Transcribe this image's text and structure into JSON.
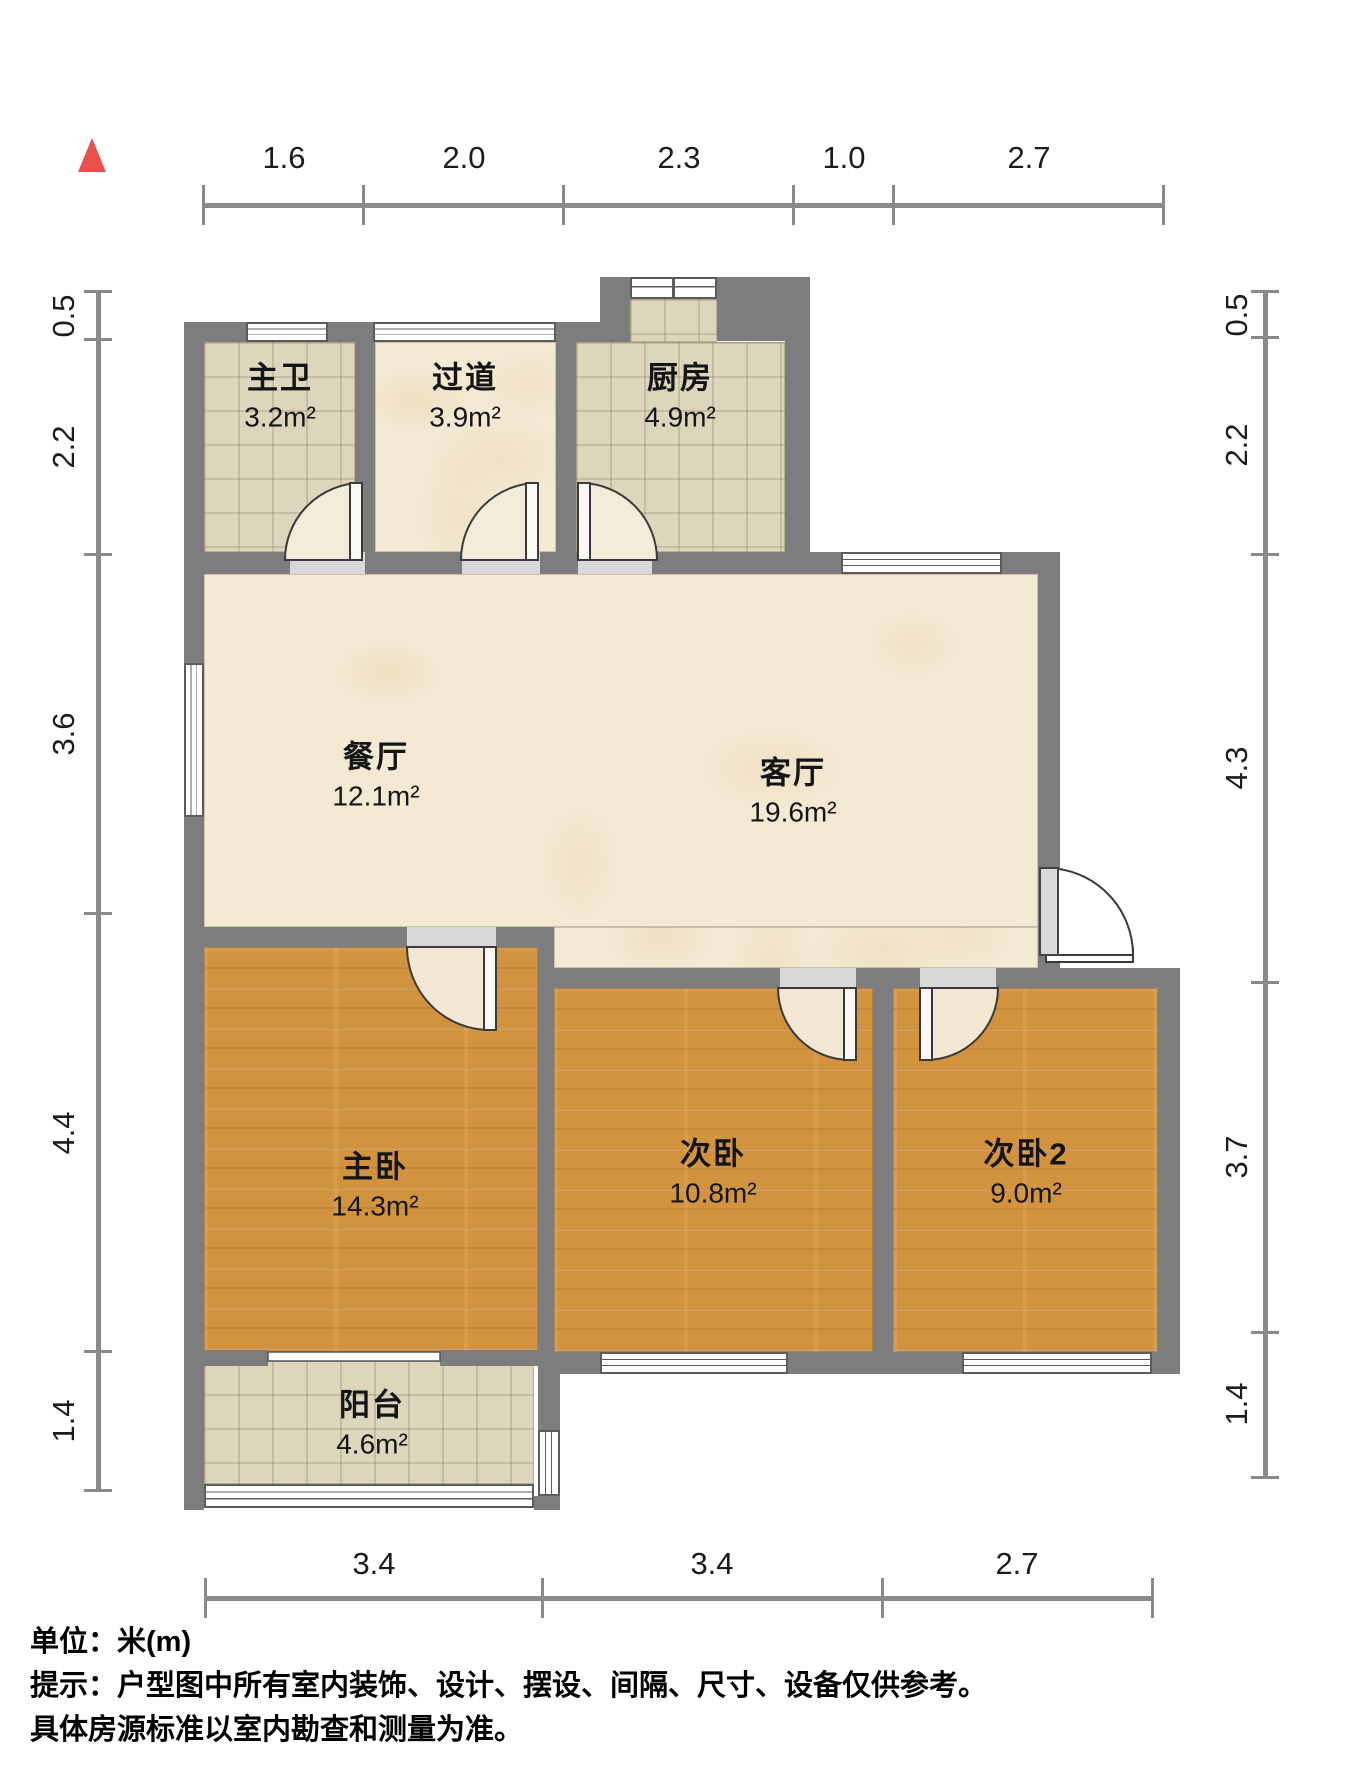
{
  "meta": {
    "unit_note": "单位：米(m)",
    "tip_line1": "提示：户型图中所有室内装饰、设计、摆设、间隔、尺寸、设备仅供参考。",
    "tip_line2": "具体房源标准以室内勘查和测量为准。"
  },
  "compass": {
    "icon": "north-arrow-icon",
    "color": "#e8504b"
  },
  "dimensions": {
    "top": [
      "1.6",
      "2.0",
      "2.3",
      "1.0",
      "2.7"
    ],
    "left": [
      "0.5",
      "2.2",
      "3.6",
      "4.4",
      "1.4"
    ],
    "right": [
      "0.5",
      "2.2",
      "4.3",
      "3.7",
      "1.4"
    ],
    "bottom": [
      "3.4",
      "3.4",
      "2.7"
    ]
  },
  "rooms": [
    {
      "key": "master-bath",
      "name": "主卫",
      "area": "3.2m²"
    },
    {
      "key": "hallway",
      "name": "过道",
      "area": "3.9m²"
    },
    {
      "key": "kitchen",
      "name": "厨房",
      "area": "4.9m²"
    },
    {
      "key": "dining",
      "name": "餐厅",
      "area": "12.1m²"
    },
    {
      "key": "living",
      "name": "客厅",
      "area": "19.6m²"
    },
    {
      "key": "master-bedroom",
      "name": "主卧",
      "area": "14.3m²"
    },
    {
      "key": "bedroom2",
      "name": "次卧",
      "area": "10.8m²"
    },
    {
      "key": "bedroom3",
      "name": "次卧2",
      "area": "9.0m²"
    },
    {
      "key": "balcony",
      "name": "阳台",
      "area": "4.6m²"
    }
  ],
  "colors": {
    "wall": "#7d7d7d",
    "wood_floor": "#d2933f",
    "tile_floor": "#ddd6bc",
    "marble_floor": "#f4ead4",
    "window_frame": "#5c5c5c",
    "dimension_line": "#8a8a8a",
    "north_arrow": "#e8504b"
  }
}
